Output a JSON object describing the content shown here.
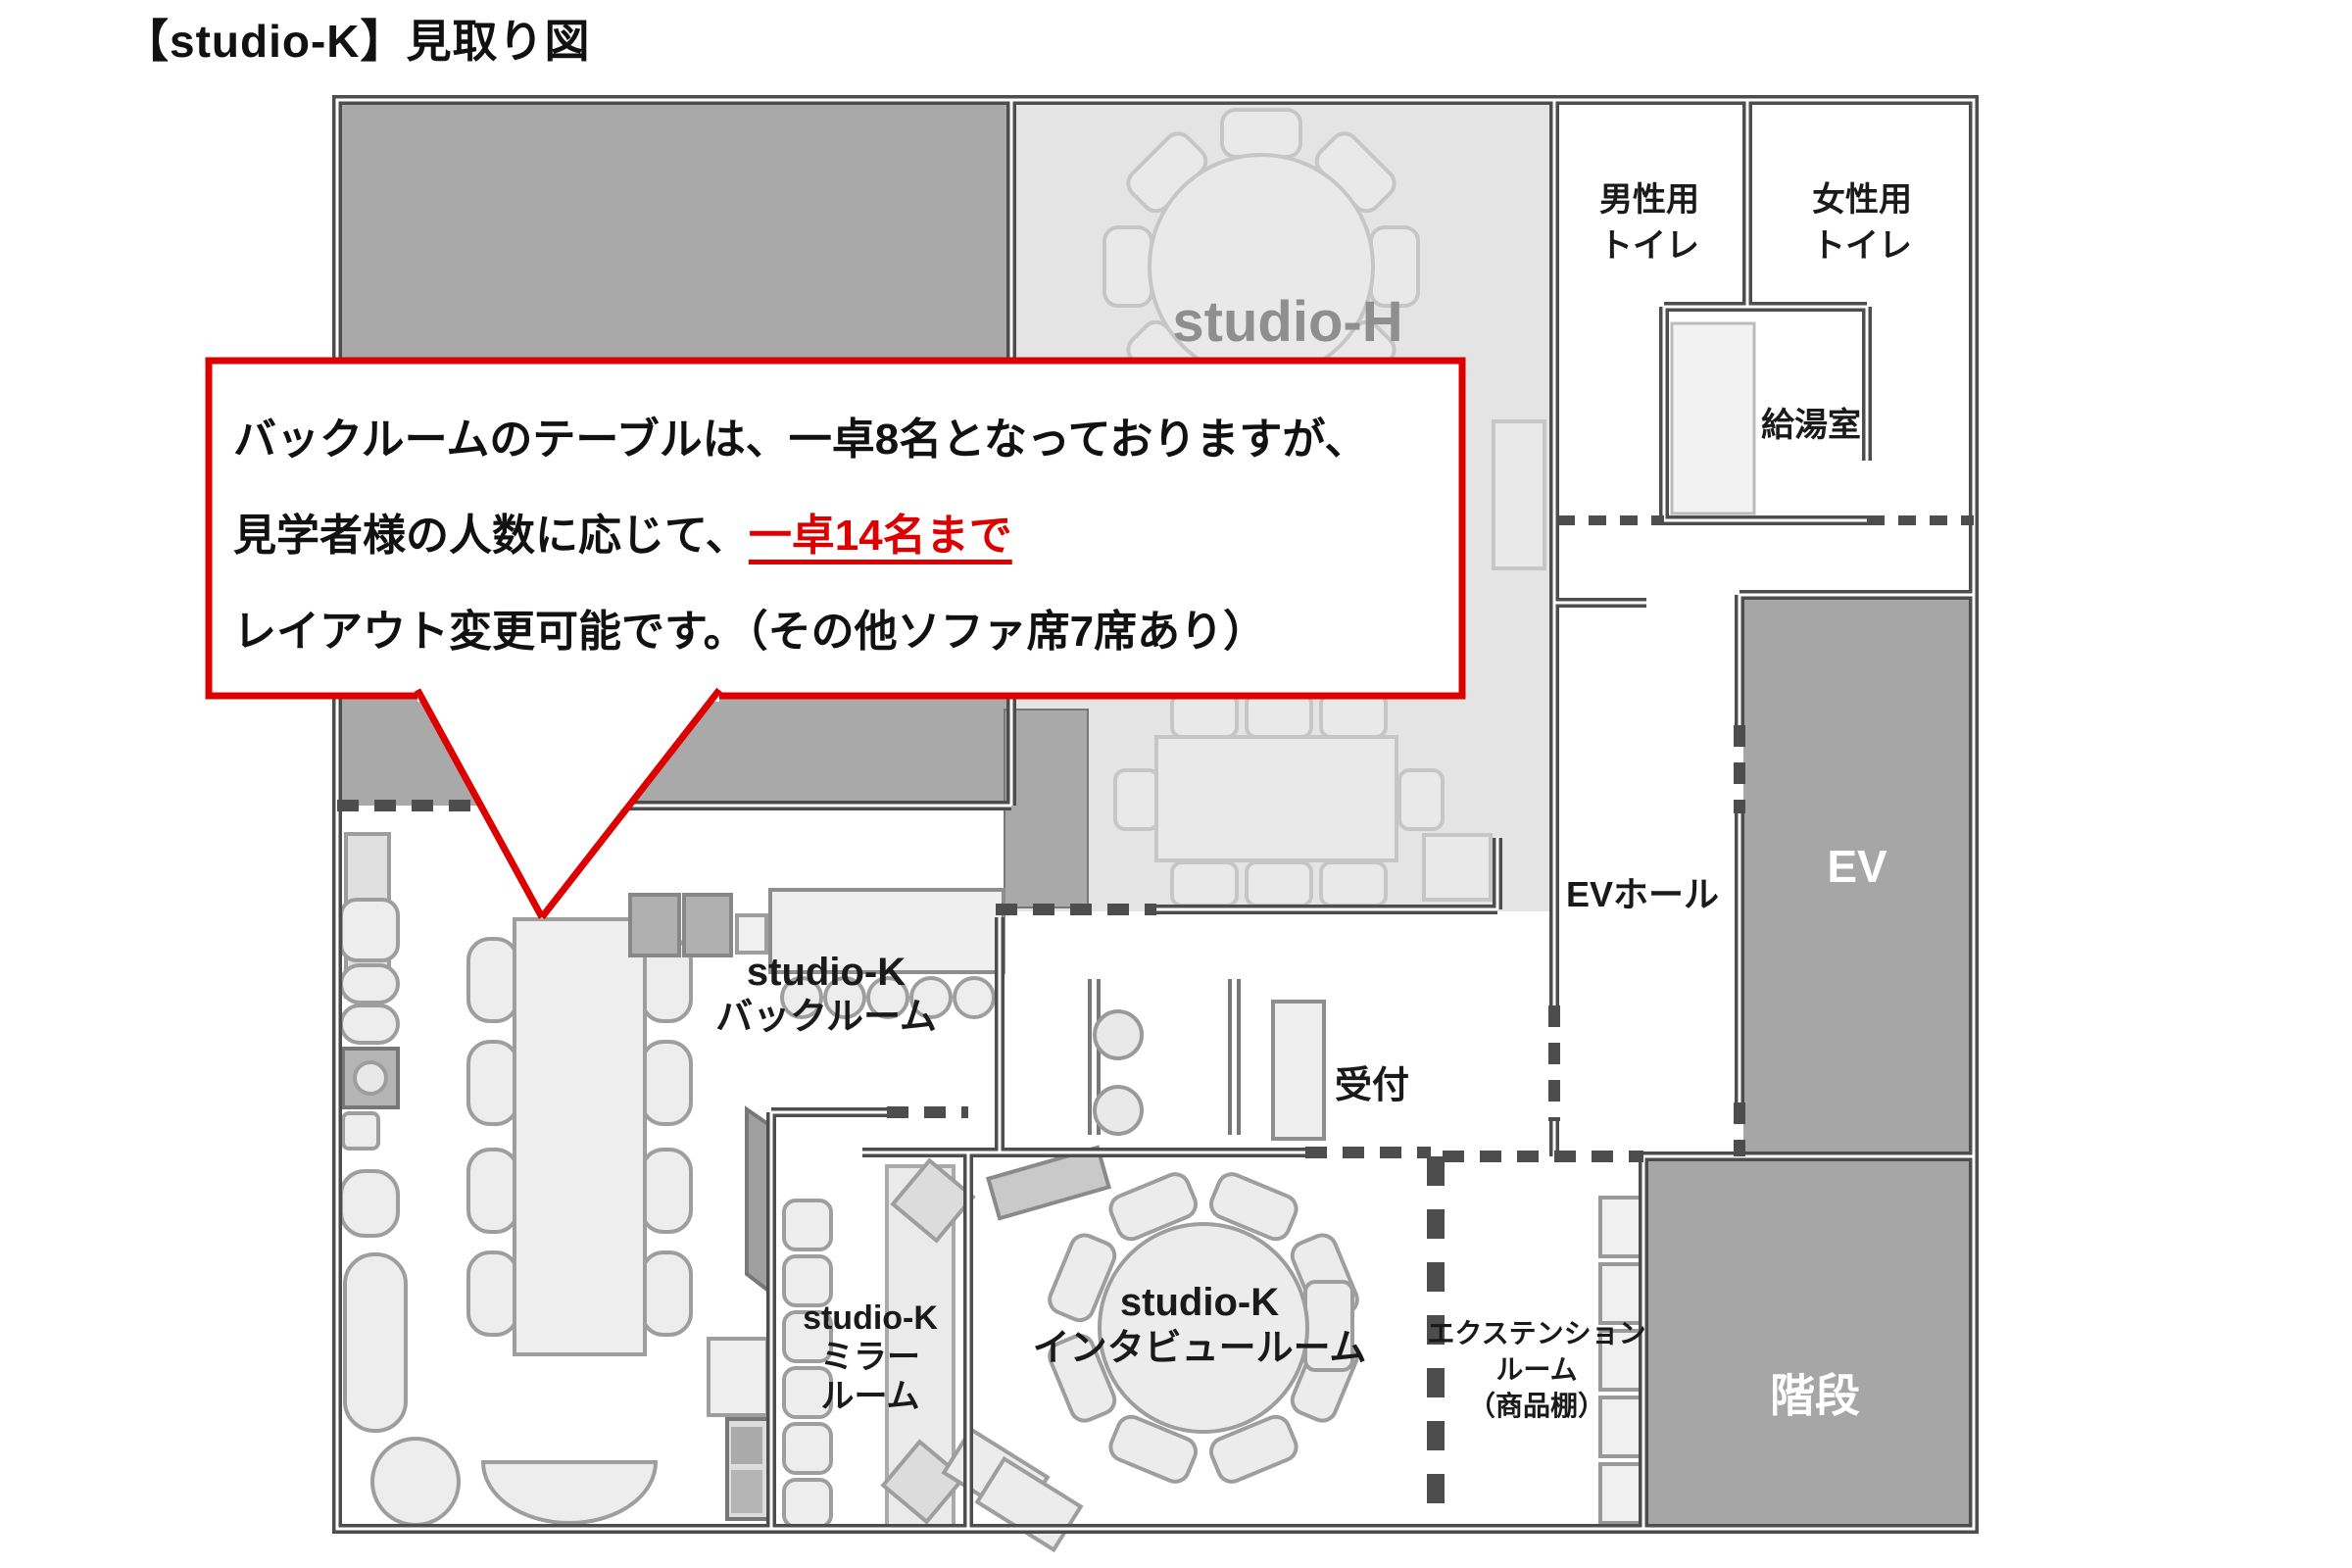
{
  "title": "【studio-K】見取り図",
  "callout": {
    "line1": "バックルームのテーブルは、一卓8名となっておりますが、",
    "line2_black": "見学者様の人数に応じて、",
    "line2_red": "一卓14名まで",
    "line3": "レイアウト変更可能です。（その他ソファ席7席あり）"
  },
  "rooms": {
    "studio_h": "studio-H",
    "mens_toilet_line1": "男性用",
    "mens_toilet_line2": "トイレ",
    "womens_toilet_line1": "女性用",
    "womens_toilet_line2": "トイレ",
    "kitchenette": "給湯室",
    "ev_hall": "EVホール",
    "elevator": "EV",
    "stairs": "階段",
    "reception": "受付",
    "backroom_line1": "studio-K",
    "backroom_line2": "バックルーム",
    "mirror_line1": "studio-K",
    "mirror_line2": "ミラー",
    "mirror_line3": "ルーム",
    "interview_line1": "studio-K",
    "interview_line2": "インタビュールーム",
    "extension_line1": "エクステンション",
    "extension_line2": "ルーム",
    "extension_line3": "（商品棚）"
  },
  "colors": {
    "callout_red": "#dd0000",
    "wall": "#4d4d4d",
    "dark_room_fill": "#a6a6a6",
    "studio_h_floor": "#e4e4e4",
    "label_gray": "#8f8f8f"
  }
}
